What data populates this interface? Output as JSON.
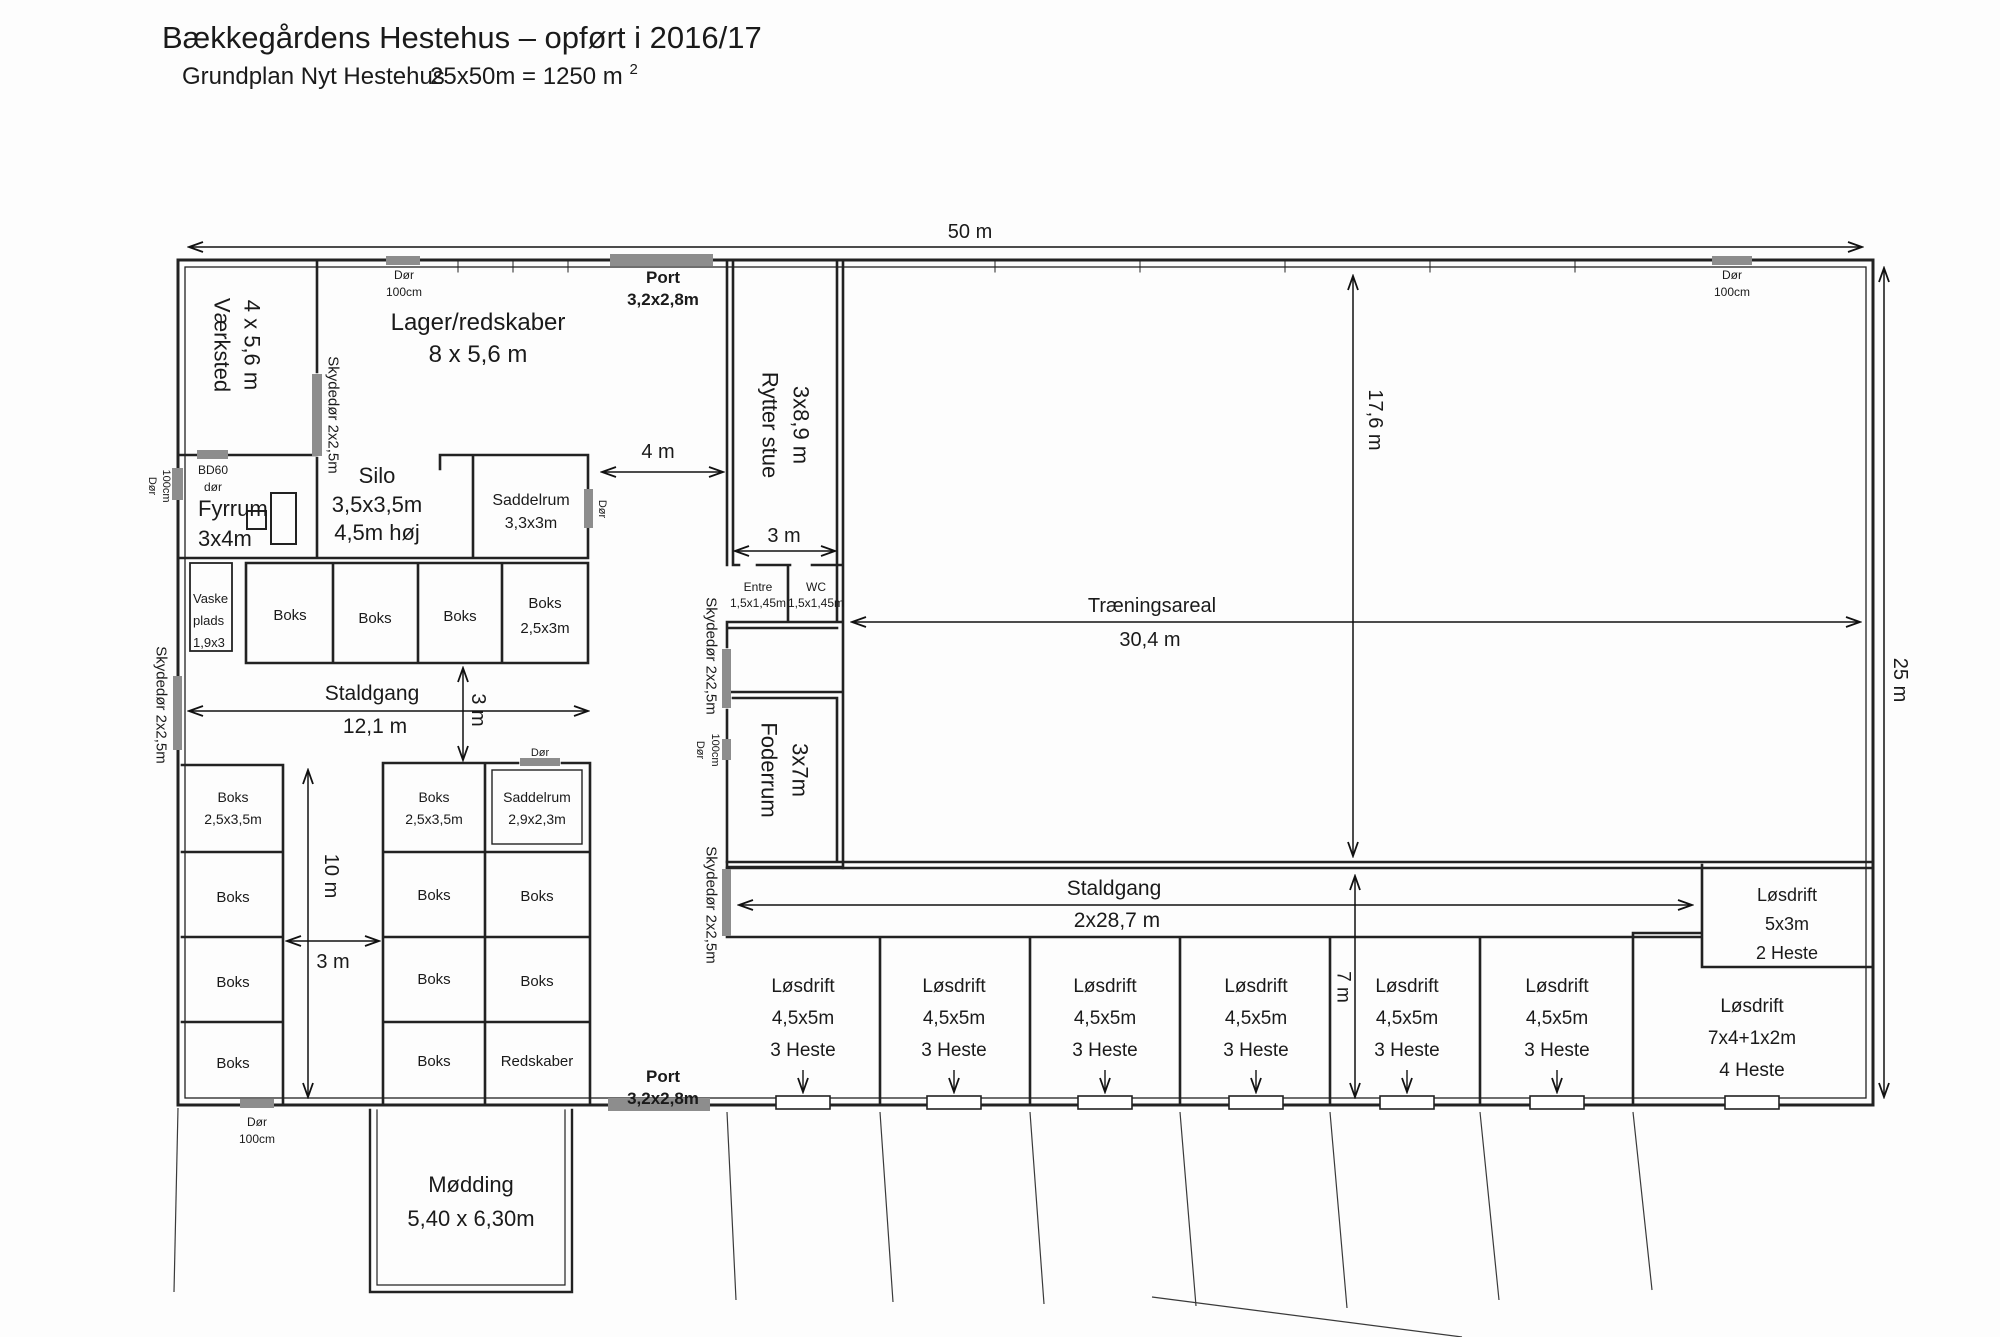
{
  "header": {
    "title": "Bækkegårdens Hestehus – opført i 2016/17",
    "subtitle": "Grundplan Nyt Hestehus",
    "area": "25x50m = 1250 m",
    "area_sup": "2"
  },
  "dims": {
    "d50": "50 m",
    "d25": "25 m",
    "d176": "17,6 m",
    "traening": "Træningsareal",
    "d304": "30,4 m",
    "d4": "4 m",
    "d3_rytter": "3 m",
    "staldgang1": "Staldgang",
    "d121": "12,1 m",
    "d3_vert": "3 m",
    "d10": "10 m",
    "d3_bottom": "3 m",
    "staldgang2": "Staldgang",
    "d287": "2x28,7 m",
    "d7": "7 m"
  },
  "rooms": {
    "vaerksted": [
      "Værksted",
      "4 x 5,6 m"
    ],
    "lager": [
      "Lager/redskaber",
      "8 x 5,6 m"
    ],
    "fyrrum": [
      "Fyrrum",
      "3x4m"
    ],
    "silo": [
      "Silo",
      "3,5x3,5m",
      "4,5m høj"
    ],
    "saddelrum1": [
      "Saddelrum",
      "3,3x3m"
    ],
    "vaskeplads": [
      "Vaske",
      "plads",
      "1,9x3"
    ],
    "rytterstue": [
      "Rytter stue",
      "3x8,9 m"
    ],
    "entre": [
      "Entre",
      "1,5x1,45m"
    ],
    "wc": [
      "WC",
      "1,5x1,45m"
    ],
    "foderrum": [
      "Foderrum",
      "3x7m"
    ],
    "saddelrum2": [
      "Saddelrum",
      "2,9x2,3m"
    ],
    "redskaber": "Redskaber",
    "moedding": [
      "Mødding",
      "5,40 x 6,30m"
    ]
  },
  "boks": {
    "plain": "Boks",
    "b25x3": [
      "Boks",
      "2,5x3m"
    ],
    "b25x35": [
      "Boks",
      "2,5x3,5m"
    ]
  },
  "loesdrift": {
    "standard": [
      "Løsdrift",
      "4,5x5m",
      "3 Heste"
    ],
    "corner_small": [
      "Løsdrift",
      "5x3m",
      "2 Heste"
    ],
    "corner_large": [
      "Løsdrift",
      "7x4+1x2m",
      "4 Heste"
    ]
  },
  "doors": {
    "dor": "Dør",
    "cm100": "100cm",
    "skydedor": "Skydedør 2x2,5m",
    "bd60": "BD60",
    "bd60b": "dør",
    "port": "Port",
    "port_size": "3,2x2,8m"
  },
  "colors": {
    "wall": "#222222",
    "door_fill": "#8d8d8d",
    "gray_label": "#7d7d7d",
    "door_label": "#4a4a4a",
    "dim": "#111111"
  }
}
